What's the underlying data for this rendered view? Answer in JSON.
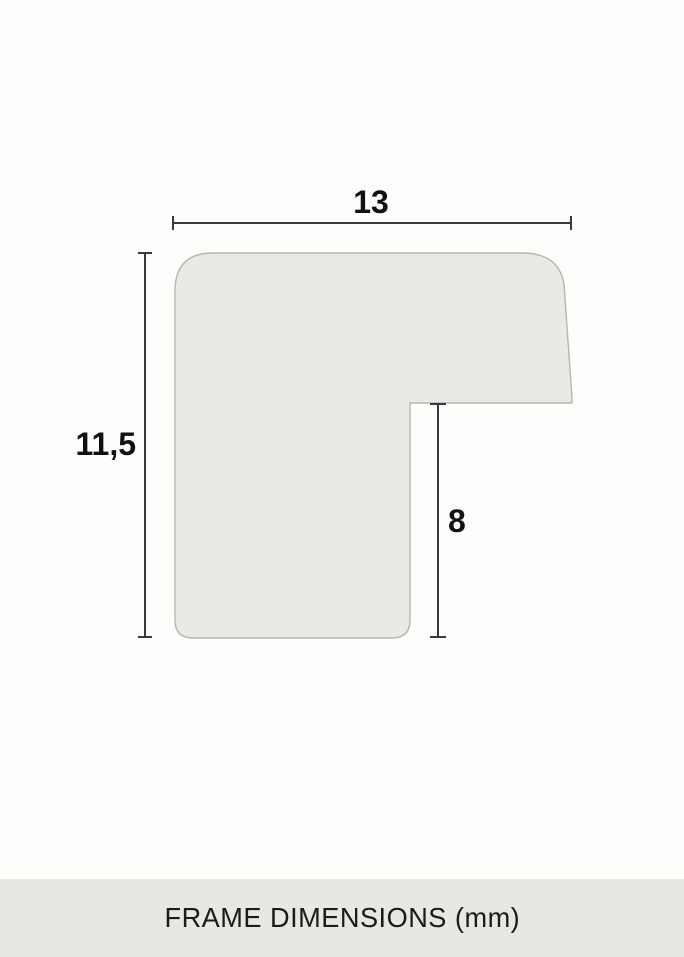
{
  "page": {
    "background": "#fdfdfc"
  },
  "diagram": {
    "name": "frame-profile-cross-section",
    "unit": "mm",
    "dimensions": {
      "width_mm": 13,
      "height_mm": 11.5,
      "rabbet_depth_mm": 8
    },
    "labels": {
      "width": "13",
      "height": "11,5",
      "depth": "8"
    },
    "colors": {
      "shape_fill": "#e9eae5",
      "shape_stroke": "#b6b6b1",
      "dimension_line": "#3a3a3a",
      "label_text": "#111111"
    }
  },
  "footer": {
    "label": "FRAME DIMENSIONS (mm)",
    "background": "#e8e8e3",
    "text_color": "#1b1b1b"
  }
}
